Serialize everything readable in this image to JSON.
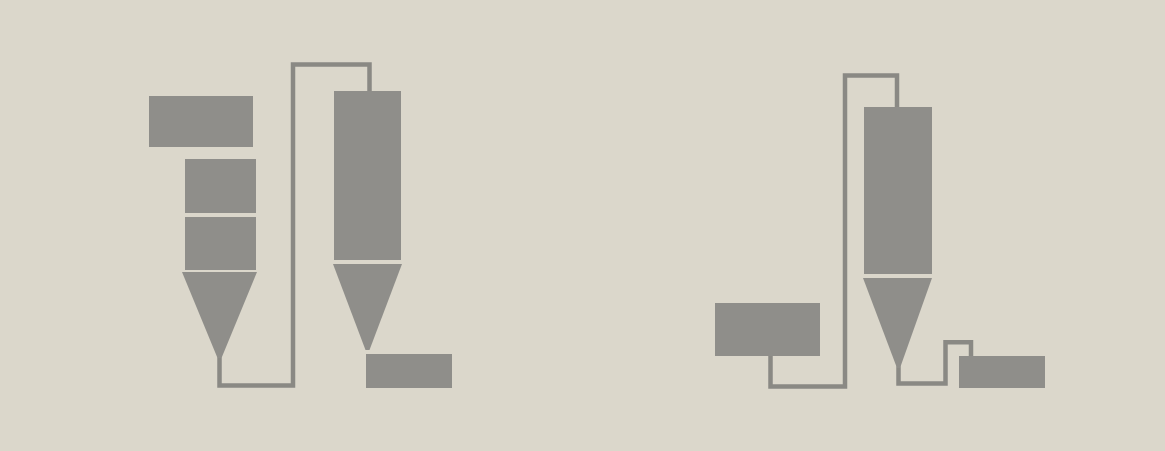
{
  "colors": {
    "background": "#dbd7cb",
    "equipment": "#8f8e8a",
    "pipe": "#8a8984"
  },
  "diagram": {
    "type": "process-flow-pictogram",
    "units": [
      {
        "name": "left-unit",
        "elements": [
          "feed-box",
          "tower-upper-section",
          "tower-lower-section",
          "tower-cone",
          "riser-pipe",
          "cyclone-body",
          "cyclone-cone",
          "collector-box"
        ]
      },
      {
        "name": "right-unit",
        "elements": [
          "feed-box",
          "feed-pipe",
          "cyclone-body",
          "cyclone-cone",
          "discharge-trap-pipe",
          "collector-box"
        ]
      }
    ]
  }
}
